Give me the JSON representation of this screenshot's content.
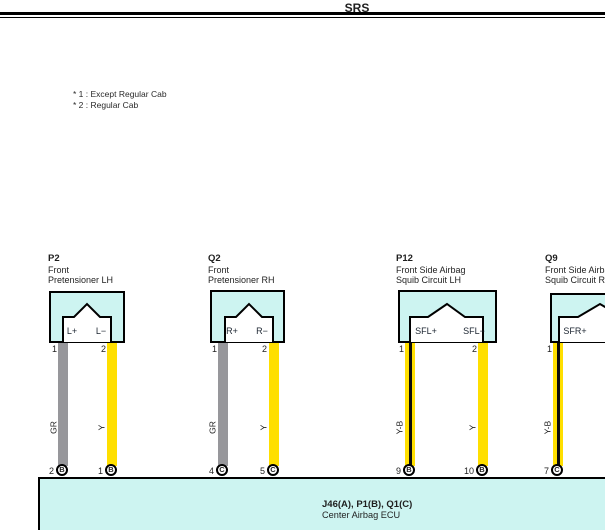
{
  "header": {
    "title": "SRS"
  },
  "notes": [
    "* 1 : Except Regular Cab",
    "* 2 : Regular Cab"
  ],
  "connectors": [
    {
      "id": "P2",
      "name_line1": "Front",
      "name_line2": "Pretensioner LH",
      "terminals": [
        {
          "pin_label": "L+",
          "pin_no": "1",
          "wire_code": "GR",
          "ecu_pin_no": "2",
          "ecu_letter": "B",
          "ecu_pin_label": "PD+"
        },
        {
          "pin_label": "L−",
          "pin_no": "2",
          "wire_code": "Y",
          "ecu_pin_no": "1",
          "ecu_letter": "B",
          "ecu_pin_label": "PD−"
        }
      ]
    },
    {
      "id": "Q2",
      "name_line1": "Front",
      "name_line2": "Pretensioner RH",
      "terminals": [
        {
          "pin_label": "R+",
          "pin_no": "1",
          "wire_code": "GR",
          "ecu_pin_no": "4",
          "ecu_letter": "C",
          "ecu_pin_label": "PP+"
        },
        {
          "pin_label": "R−",
          "pin_no": "2",
          "wire_code": "Y",
          "ecu_pin_no": "5",
          "ecu_letter": "C",
          "ecu_pin_label": "PP−"
        }
      ]
    },
    {
      "id": "P12",
      "name_line1": "Front Side Airbag",
      "name_line2": "Squib Circuit LH",
      "terminals": [
        {
          "pin_label": "SFL+",
          "pin_no": "1",
          "wire_code": "Y-B",
          "ecu_pin_no": "9",
          "ecu_letter": "B",
          "ecu_pin_label": "SFD+"
        },
        {
          "pin_label": "SFL−",
          "pin_no": "2",
          "wire_code": "Y",
          "ecu_pin_no": "10",
          "ecu_letter": "B",
          "ecu_pin_label": "SFD−"
        }
      ]
    },
    {
      "id": "Q9",
      "name_line1": "Front Side Airbag",
      "name_line2": "Squib Circuit RH",
      "terminals": [
        {
          "pin_label": "SFR+",
          "pin_no": "1",
          "wire_code": "Y-B",
          "ecu_pin_no": "7",
          "ecu_letter": "C",
          "ecu_pin_label": "SFP+"
        }
      ]
    }
  ],
  "ecu": {
    "id_line": "J46(A), P1(B), Q1(C)",
    "name_line": "Center Airbag ECU"
  },
  "colors": {
    "page_bg": "#ffffff",
    "line": "#000000",
    "box_fill": "#cdf4f1",
    "wire_gray": "#97979b",
    "wire_yellow": "#ffdf00",
    "wire_stripe": "#0d0d0d",
    "pin_ink": "#1b2430",
    "text_ink": "#1f1f1f"
  }
}
